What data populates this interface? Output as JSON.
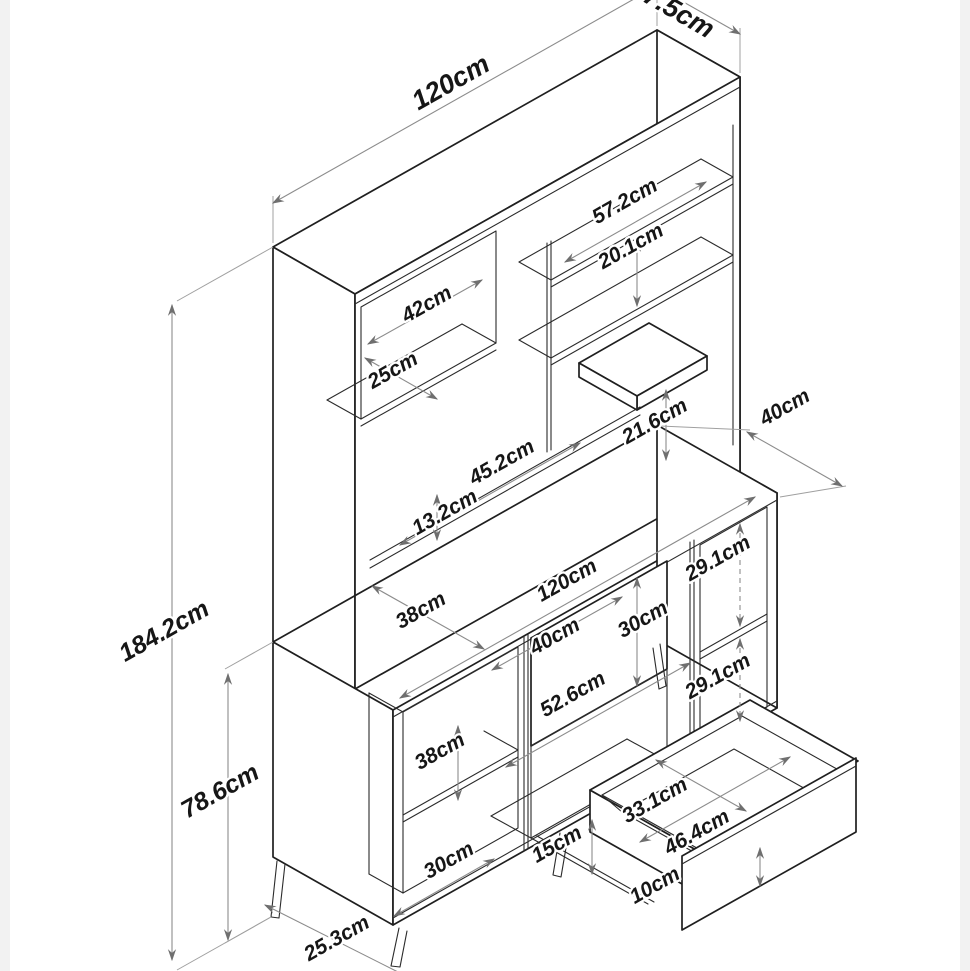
{
  "dims": {
    "hutch_depth": "27.5cm",
    "hutch_width": "120cm",
    "shelf_width": "57.2cm",
    "shelf_gap": "20.1cm",
    "cubby_width": "42cm",
    "cubby_depth": "25cm",
    "mini_shelf_clearance": "21.6cm",
    "base_depth": "40cm",
    "niche_width": "45.2cm",
    "niche_height": "13.2cm",
    "base_width": "120cm",
    "left_inner_depth": "38cm",
    "drawer_opening_width": "40cm",
    "drawer_front_height": "30cm",
    "right_upper_opening": "29.1cm",
    "right_lower_opening": "29.1cm",
    "drawer_front_width": "52.6cm",
    "total_height": "184.2cm",
    "left_opening_height": "38cm",
    "base_height": "78.6cm",
    "drawer_inner_depth": "33.1cm",
    "drawer_inner_width": "46.4cm",
    "bottom_opening_width": "30cm",
    "leg_height": "15cm",
    "drawer_bottom_gap": "10cm",
    "leg_spacing": "25.3cm"
  }
}
